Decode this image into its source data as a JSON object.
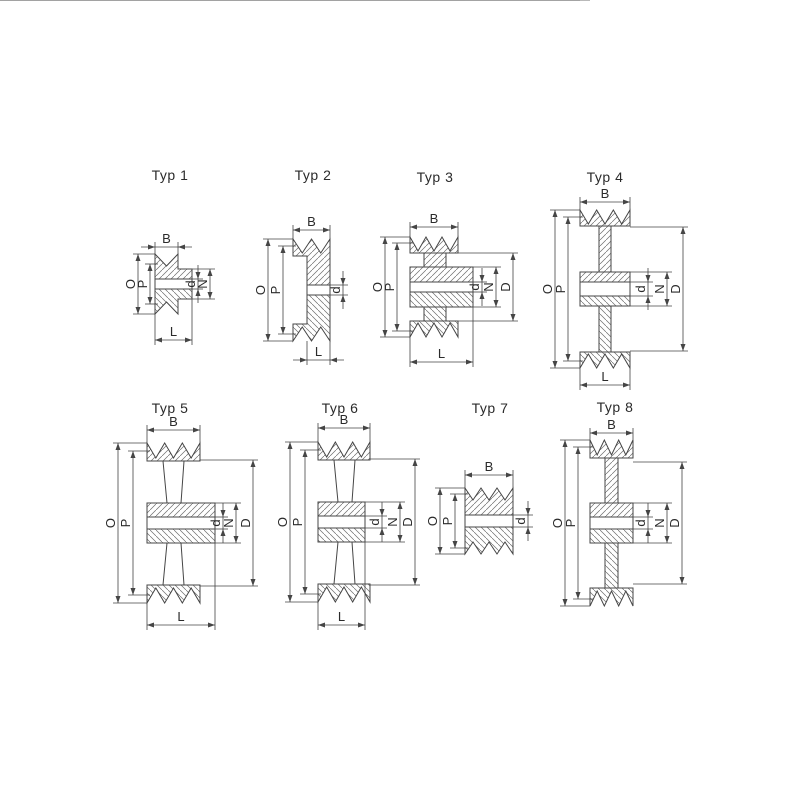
{
  "page": {
    "background": "#ffffff"
  },
  "drawing": {
    "line_color": "#454545",
    "hatch_color": "#6e6e6e",
    "text_color": "#2b2b2b"
  },
  "figures": [
    {
      "id": "typ-1",
      "title": "Typ 1",
      "dimensions": [
        "B",
        "O",
        "P",
        "d",
        "N",
        "L"
      ]
    },
    {
      "id": "typ-2",
      "title": "Typ 2",
      "dimensions": [
        "B",
        "O",
        "P",
        "d",
        "L"
      ]
    },
    {
      "id": "typ-3",
      "title": "Typ 3",
      "dimensions": [
        "B",
        "O",
        "P",
        "d",
        "N",
        "D",
        "L"
      ]
    },
    {
      "id": "typ-4",
      "title": "Typ 4",
      "dimensions": [
        "B",
        "O",
        "P",
        "d",
        "N",
        "D",
        "L"
      ]
    },
    {
      "id": "typ-5",
      "title": "Typ 5",
      "dimensions": [
        "B",
        "O",
        "P",
        "d",
        "N",
        "D",
        "L"
      ]
    },
    {
      "id": "typ-6",
      "title": "Typ 6",
      "dimensions": [
        "B",
        "O",
        "P",
        "d",
        "N",
        "D",
        "L"
      ]
    },
    {
      "id": "typ-7",
      "title": "Typ 7",
      "dimensions": [
        "B",
        "O",
        "P",
        "d"
      ]
    },
    {
      "id": "typ-8",
      "title": "Typ 8",
      "dimensions": [
        "B",
        "O",
        "P",
        "d",
        "N",
        "D"
      ]
    }
  ]
}
